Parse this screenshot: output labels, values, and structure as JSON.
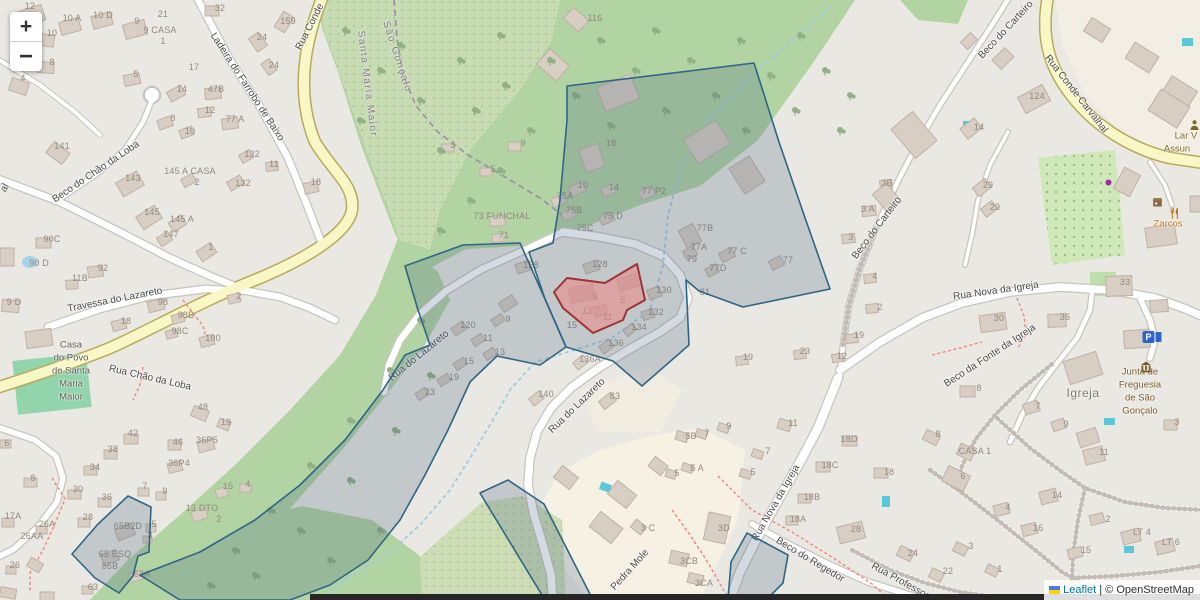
{
  "controls": {
    "zoom_in": "+",
    "zoom_out": "−"
  },
  "attribution": {
    "leaflet_label": "Leaflet",
    "separator": "|",
    "osm_label": "© OpenStreetMap"
  },
  "colors": {
    "overlay_stroke": "#2d6687",
    "overlay_fill": "rgba(70,100,130,0.24)",
    "highlight_stroke": "#9e3333",
    "highlight_fill": "rgba(232,140,140,0.62)",
    "forest": "#b2d3a2",
    "scrub": "#c7dcb2",
    "orchard": "#cfe8b8",
    "road_yellow": "#f9f7c6",
    "road_yellow_casing": "#b5ab5a",
    "road_white": "#ffffff",
    "road_casing": "#c9c4bd",
    "pitch": "#92d5ac",
    "water": "#a8d2e8",
    "pool": "#5ac8d8",
    "stream": "#9fcce4",
    "path_red": "#fa8072",
    "admin_boundary": "#9b85a8"
  },
  "street_labels": [
    {
      "t": "Ladeira do Farrobo de Baixo",
      "x": 247,
      "y": 87,
      "r": 57
    },
    {
      "t": "Rua Conde",
      "x": 310,
      "y": 27,
      "r": -63
    },
    {
      "t": "Beco do Chão da Loba",
      "x": 96,
      "y": 172,
      "r": -34
    },
    {
      "t": "Travessa do Lazareto",
      "x": 115,
      "y": 300,
      "r": -11
    },
    {
      "t": "Rua Chão da Loba",
      "x": 150,
      "y": 378,
      "r": 13
    },
    {
      "t": "Rua do Lazareto",
      "x": 419,
      "y": 356,
      "r": -39
    },
    {
      "t": "Rua do Lazareto",
      "x": 577,
      "y": 406,
      "r": -44
    },
    {
      "t": "Beco do Carteiro",
      "x": 1006,
      "y": 30,
      "r": -47
    },
    {
      "t": "Beco do Carteiro",
      "x": 877,
      "y": 228,
      "r": -53
    },
    {
      "t": "Rua Conde Carvalhal",
      "x": 1076,
      "y": 94,
      "r": 52
    },
    {
      "t": "Rua Nova da Igreja",
      "x": 996,
      "y": 291,
      "r": -8
    },
    {
      "t": "Beco da Fonte da Igreja",
      "x": 990,
      "y": 356,
      "r": -33
    },
    {
      "t": "Rua Nova da Igreja",
      "x": 776,
      "y": 503,
      "r": -60
    },
    {
      "t": "Beco do Regedor",
      "x": 810,
      "y": 560,
      "r": 31
    },
    {
      "t": "Rua Professor",
      "x": 900,
      "y": 581,
      "r": 29
    },
    {
      "t": "Pedra Mole",
      "x": 630,
      "y": 570,
      "r": -48
    },
    {
      "t": "al",
      "x": 5,
      "y": 188,
      "r": -60
    }
  ],
  "boundary_labels": [
    {
      "t": "Santa Maria Maior",
      "x": 367,
      "y": 84,
      "r": 83
    },
    {
      "t": "São Gonçalo",
      "x": 397,
      "y": 57,
      "r": 72
    }
  ],
  "place_labels": [
    {
      "t": "Igreja",
      "x": 1083,
      "y": 393
    }
  ],
  "poi_labels": [
    {
      "t": "Zarcos",
      "x": 1168,
      "y": 224,
      "c": "#c17817"
    },
    {
      "t": "Lar V",
      "x": 1186,
      "y": 136,
      "c": "#7e6b1e"
    },
    {
      "t": "Assun",
      "x": 1177,
      "y": 149,
      "c": "#7e6b1e"
    },
    {
      "t": "Junta de",
      "x": 1140,
      "y": 372,
      "c": "#7a5b2a"
    },
    {
      "t": "Freguesia",
      "x": 1140,
      "y": 385,
      "c": "#7a5b2a"
    },
    {
      "t": "de São",
      "x": 1140,
      "y": 398,
      "c": "#7a5b2a"
    },
    {
      "t": "Gonçalo",
      "x": 1140,
      "y": 411,
      "c": "#7a5b2a"
    },
    {
      "t": "Casa",
      "x": 71,
      "y": 345,
      "c": "#5c5c54"
    },
    {
      "t": "do Povo",
      "x": 71,
      "y": 358,
      "c": "#5c5c54"
    },
    {
      "t": "de Santa",
      "x": 71,
      "y": 371,
      "c": "#5c5c54"
    },
    {
      "t": "Maria",
      "x": 71,
      "y": 384,
      "c": "#5c5c54"
    },
    {
      "t": "Maior",
      "x": 71,
      "y": 397,
      "c": "#5c5c54"
    }
  ],
  "house_numbers": [
    {
      "t": "12",
      "x": 30,
      "y": 6
    },
    {
      "t": "10 A",
      "x": 72,
      "y": 18
    },
    {
      "t": "10 D",
      "x": 103,
      "y": 15
    },
    {
      "t": "21",
      "x": 163,
      "y": 14
    },
    {
      "t": "9",
      "x": 137,
      "y": 21
    },
    {
      "t": "9 CASA",
      "x": 160,
      "y": 30
    },
    {
      "t": "1",
      "x": 163,
      "y": 41
    },
    {
      "t": "10",
      "x": 52,
      "y": 33
    },
    {
      "t": "17",
      "x": 194,
      "y": 67
    },
    {
      "t": "8",
      "x": 52,
      "y": 62
    },
    {
      "t": "4",
      "x": 23,
      "y": 78
    },
    {
      "t": "5",
      "x": 136,
      "y": 74
    },
    {
      "t": "14",
      "x": 182,
      "y": 89
    },
    {
      "t": "8",
      "x": 173,
      "y": 118
    },
    {
      "t": "10",
      "x": 190,
      "y": 131
    },
    {
      "t": "141",
      "x": 62,
      "y": 146
    },
    {
      "t": "32",
      "x": 220,
      "y": 8
    },
    {
      "t": "159",
      "x": 288,
      "y": 21
    },
    {
      "t": "24",
      "x": 262,
      "y": 37
    },
    {
      "t": "24",
      "x": 274,
      "y": 65
    },
    {
      "t": "47B",
      "x": 216,
      "y": 89
    },
    {
      "t": "12",
      "x": 210,
      "y": 110
    },
    {
      "t": "77 A",
      "x": 235,
      "y": 119
    },
    {
      "t": "132",
      "x": 252,
      "y": 154
    },
    {
      "t": "11",
      "x": 274,
      "y": 164
    },
    {
      "t": "145 A CASA",
      "x": 190,
      "y": 171
    },
    {
      "t": "2",
      "x": 197,
      "y": 182
    },
    {
      "t": "132",
      "x": 243,
      "y": 183
    },
    {
      "t": "18",
      "x": 316,
      "y": 182
    },
    {
      "t": "143",
      "x": 133,
      "y": 178
    },
    {
      "t": "145",
      "x": 152,
      "y": 212
    },
    {
      "t": "145 A",
      "x": 182,
      "y": 219
    },
    {
      "t": "147",
      "x": 171,
      "y": 234
    },
    {
      "t": "1",
      "x": 211,
      "y": 247
    },
    {
      "t": "90C",
      "x": 52,
      "y": 239
    },
    {
      "t": "90 D",
      "x": 39,
      "y": 263
    },
    {
      "t": "92",
      "x": 103,
      "y": 268
    },
    {
      "t": "11B",
      "x": 80,
      "y": 278
    },
    {
      "t": "9 D",
      "x": 14,
      "y": 302
    },
    {
      "t": "98",
      "x": 163,
      "y": 302
    },
    {
      "t": "18",
      "x": 126,
      "y": 321
    },
    {
      "t": "98B",
      "x": 186,
      "y": 315
    },
    {
      "t": "98C",
      "x": 180,
      "y": 331
    },
    {
      "t": "100",
      "x": 213,
      "y": 338
    },
    {
      "t": "2",
      "x": 239,
      "y": 296
    },
    {
      "t": "116",
      "x": 595,
      "y": 18
    },
    {
      "t": "18",
      "x": 611,
      "y": 143
    },
    {
      "t": "9",
      "x": 523,
      "y": 143
    },
    {
      "t": "3",
      "x": 453,
      "y": 145
    },
    {
      "t": "5",
      "x": 493,
      "y": 169
    },
    {
      "t": "10",
      "x": 583,
      "y": 185
    },
    {
      "t": "14",
      "x": 614,
      "y": 187
    },
    {
      "t": "75A",
      "x": 565,
      "y": 196
    },
    {
      "t": "75B",
      "x": 574,
      "y": 210
    },
    {
      "t": "75 D",
      "x": 613,
      "y": 216
    },
    {
      "t": "75C",
      "x": 585,
      "y": 228
    },
    {
      "t": "77 P2",
      "x": 654,
      "y": 191
    },
    {
      "t": "73 FUNCHAL",
      "x": 502,
      "y": 216
    },
    {
      "t": "71",
      "x": 504,
      "y": 235
    },
    {
      "t": "128",
      "x": 531,
      "y": 265
    },
    {
      "t": "128",
      "x": 600,
      "y": 264
    },
    {
      "t": "130",
      "x": 664,
      "y": 290
    },
    {
      "t": "132",
      "x": 656,
      "y": 312
    },
    {
      "t": "134",
      "x": 639,
      "y": 327
    },
    {
      "t": "136",
      "x": 616,
      "y": 343
    },
    {
      "t": "136A",
      "x": 590,
      "y": 359
    },
    {
      "t": "81",
      "x": 705,
      "y": 292
    },
    {
      "t": "77B",
      "x": 705,
      "y": 228
    },
    {
      "t": "77A",
      "x": 699,
      "y": 247
    },
    {
      "t": "79",
      "x": 692,
      "y": 259
    },
    {
      "t": "77 C",
      "x": 737,
      "y": 251
    },
    {
      "t": "77D",
      "x": 718,
      "y": 268
    },
    {
      "t": "77",
      "x": 788,
      "y": 260
    },
    {
      "t": "9",
      "x": 595,
      "y": 297
    },
    {
      "t": "5",
      "x": 623,
      "y": 300
    },
    {
      "t": "13",
      "x": 587,
      "y": 311
    },
    {
      "t": "11",
      "x": 608,
      "y": 317
    },
    {
      "t": "15",
      "x": 572,
      "y": 325
    },
    {
      "t": "120",
      "x": 468,
      "y": 325
    },
    {
      "t": "9",
      "x": 508,
      "y": 319
    },
    {
      "t": "11",
      "x": 488,
      "y": 338
    },
    {
      "t": "13",
      "x": 500,
      "y": 352
    },
    {
      "t": "15",
      "x": 469,
      "y": 361
    },
    {
      "t": "19",
      "x": 454,
      "y": 377
    },
    {
      "t": "23",
      "x": 430,
      "y": 392
    },
    {
      "t": "140",
      "x": 546,
      "y": 394
    },
    {
      "t": "83",
      "x": 615,
      "y": 396
    },
    {
      "t": "3B",
      "x": 887,
      "y": 183
    },
    {
      "t": "3 A",
      "x": 868,
      "y": 209
    },
    {
      "t": "3",
      "x": 851,
      "y": 237
    },
    {
      "t": "4",
      "x": 875,
      "y": 276
    },
    {
      "t": "2",
      "x": 880,
      "y": 307
    },
    {
      "t": "19",
      "x": 859,
      "y": 335
    },
    {
      "t": "23",
      "x": 805,
      "y": 351
    },
    {
      "t": "12",
      "x": 842,
      "y": 356
    },
    {
      "t": "19",
      "x": 748,
      "y": 357
    },
    {
      "t": "124",
      "x": 1037,
      "y": 96
    },
    {
      "t": "14",
      "x": 979,
      "y": 127
    },
    {
      "t": "29",
      "x": 988,
      "y": 185
    },
    {
      "t": "29",
      "x": 995,
      "y": 207
    },
    {
      "t": "33",
      "x": 1125,
      "y": 282
    },
    {
      "t": "30",
      "x": 999,
      "y": 318
    },
    {
      "t": "36",
      "x": 1065,
      "y": 317
    },
    {
      "t": "8",
      "x": 979,
      "y": 388
    },
    {
      "t": "7",
      "x": 1038,
      "y": 406
    },
    {
      "t": "9",
      "x": 1066,
      "y": 424
    },
    {
      "t": "3",
      "x": 1177,
      "y": 422
    },
    {
      "t": "48",
      "x": 203,
      "y": 407
    },
    {
      "t": "19",
      "x": 226,
      "y": 422
    },
    {
      "t": "42",
      "x": 133,
      "y": 433
    },
    {
      "t": "46",
      "x": 178,
      "y": 442
    },
    {
      "t": "36P5",
      "x": 207,
      "y": 440
    },
    {
      "t": "38",
      "x": 113,
      "y": 449
    },
    {
      "t": "36P4",
      "x": 179,
      "y": 463
    },
    {
      "t": "34",
      "x": 95,
      "y": 467
    },
    {
      "t": "6",
      "x": 7,
      "y": 443
    },
    {
      "t": "8",
      "x": 33,
      "y": 478
    },
    {
      "t": "30",
      "x": 78,
      "y": 489
    },
    {
      "t": "36",
      "x": 107,
      "y": 497
    },
    {
      "t": "7",
      "x": 145,
      "y": 486
    },
    {
      "t": "9",
      "x": 165,
      "y": 491
    },
    {
      "t": "15",
      "x": 228,
      "y": 486
    },
    {
      "t": "13 DTO",
      "x": 202,
      "y": 508
    },
    {
      "t": "2",
      "x": 219,
      "y": 519
    },
    {
      "t": "17A",
      "x": 13,
      "y": 516
    },
    {
      "t": "28",
      "x": 88,
      "y": 517
    },
    {
      "t": "26A",
      "x": 47,
      "y": 524
    },
    {
      "t": "26AA",
      "x": 32,
      "y": 536
    },
    {
      "t": "65B2D",
      "x": 128,
      "y": 526
    },
    {
      "t": "5",
      "x": 154,
      "y": 524
    },
    {
      "t": "3",
      "x": 150,
      "y": 535
    },
    {
      "t": "65 ESQ",
      "x": 115,
      "y": 554
    },
    {
      "t": "65B",
      "x": 110,
      "y": 566
    },
    {
      "t": "26",
      "x": 15,
      "y": 565
    },
    {
      "t": "63A",
      "x": 142,
      "y": 574
    },
    {
      "t": "63",
      "x": 93,
      "y": 587
    },
    {
      "t": "4",
      "x": 248,
      "y": 484
    },
    {
      "t": "5B",
      "x": 691,
      "y": 436
    },
    {
      "t": "7",
      "x": 707,
      "y": 433
    },
    {
      "t": "9",
      "x": 729,
      "y": 426
    },
    {
      "t": "11",
      "x": 793,
      "y": 423
    },
    {
      "t": "7",
      "x": 768,
      "y": 451
    },
    {
      "t": "5 A",
      "x": 697,
      "y": 468
    },
    {
      "t": "5",
      "x": 677,
      "y": 473
    },
    {
      "t": "5",
      "x": 753,
      "y": 472
    },
    {
      "t": "3D",
      "x": 724,
      "y": 528
    },
    {
      "t": "3CB",
      "x": 689,
      "y": 561
    },
    {
      "t": "3CA",
      "x": 704,
      "y": 583
    },
    {
      "t": "3 C",
      "x": 648,
      "y": 528
    },
    {
      "t": "18D",
      "x": 849,
      "y": 439
    },
    {
      "t": "18C",
      "x": 830,
      "y": 465
    },
    {
      "t": "18B",
      "x": 812,
      "y": 497
    },
    {
      "t": "18A",
      "x": 798,
      "y": 519
    },
    {
      "t": "28",
      "x": 856,
      "y": 529
    },
    {
      "t": "18",
      "x": 889,
      "y": 472
    },
    {
      "t": "24",
      "x": 913,
      "y": 553
    },
    {
      "t": "8",
      "x": 938,
      "y": 434
    },
    {
      "t": "CASA 1",
      "x": 975,
      "y": 451
    },
    {
      "t": "6",
      "x": 963,
      "y": 476
    },
    {
      "t": "11",
      "x": 1104,
      "y": 452
    },
    {
      "t": "14",
      "x": 1057,
      "y": 495
    },
    {
      "t": "4",
      "x": 1008,
      "y": 507
    },
    {
      "t": "2",
      "x": 1108,
      "y": 519
    },
    {
      "t": "16",
      "x": 1038,
      "y": 528
    },
    {
      "t": "LT 4",
      "x": 1142,
      "y": 532
    },
    {
      "t": "LT 6",
      "x": 1171,
      "y": 542
    },
    {
      "t": "15",
      "x": 1086,
      "y": 550
    },
    {
      "t": "3",
      "x": 971,
      "y": 546
    },
    {
      "t": "22",
      "x": 948,
      "y": 571
    },
    {
      "t": "1",
      "x": 1000,
      "y": 569
    }
  ],
  "poi_icons": [
    {
      "n": "restaurant-icon",
      "x": 1168,
      "y": 207
    },
    {
      "n": "shop-icon",
      "x": 1151,
      "y": 196
    },
    {
      "n": "social-facility-icon",
      "x": 1188,
      "y": 119
    },
    {
      "n": "townhall-icon",
      "x": 1139,
      "y": 360
    },
    {
      "n": "parking-icon",
      "x": 1152,
      "y": 337
    },
    {
      "n": "poi-dot-icon",
      "x": 1104,
      "y": 178
    }
  ]
}
